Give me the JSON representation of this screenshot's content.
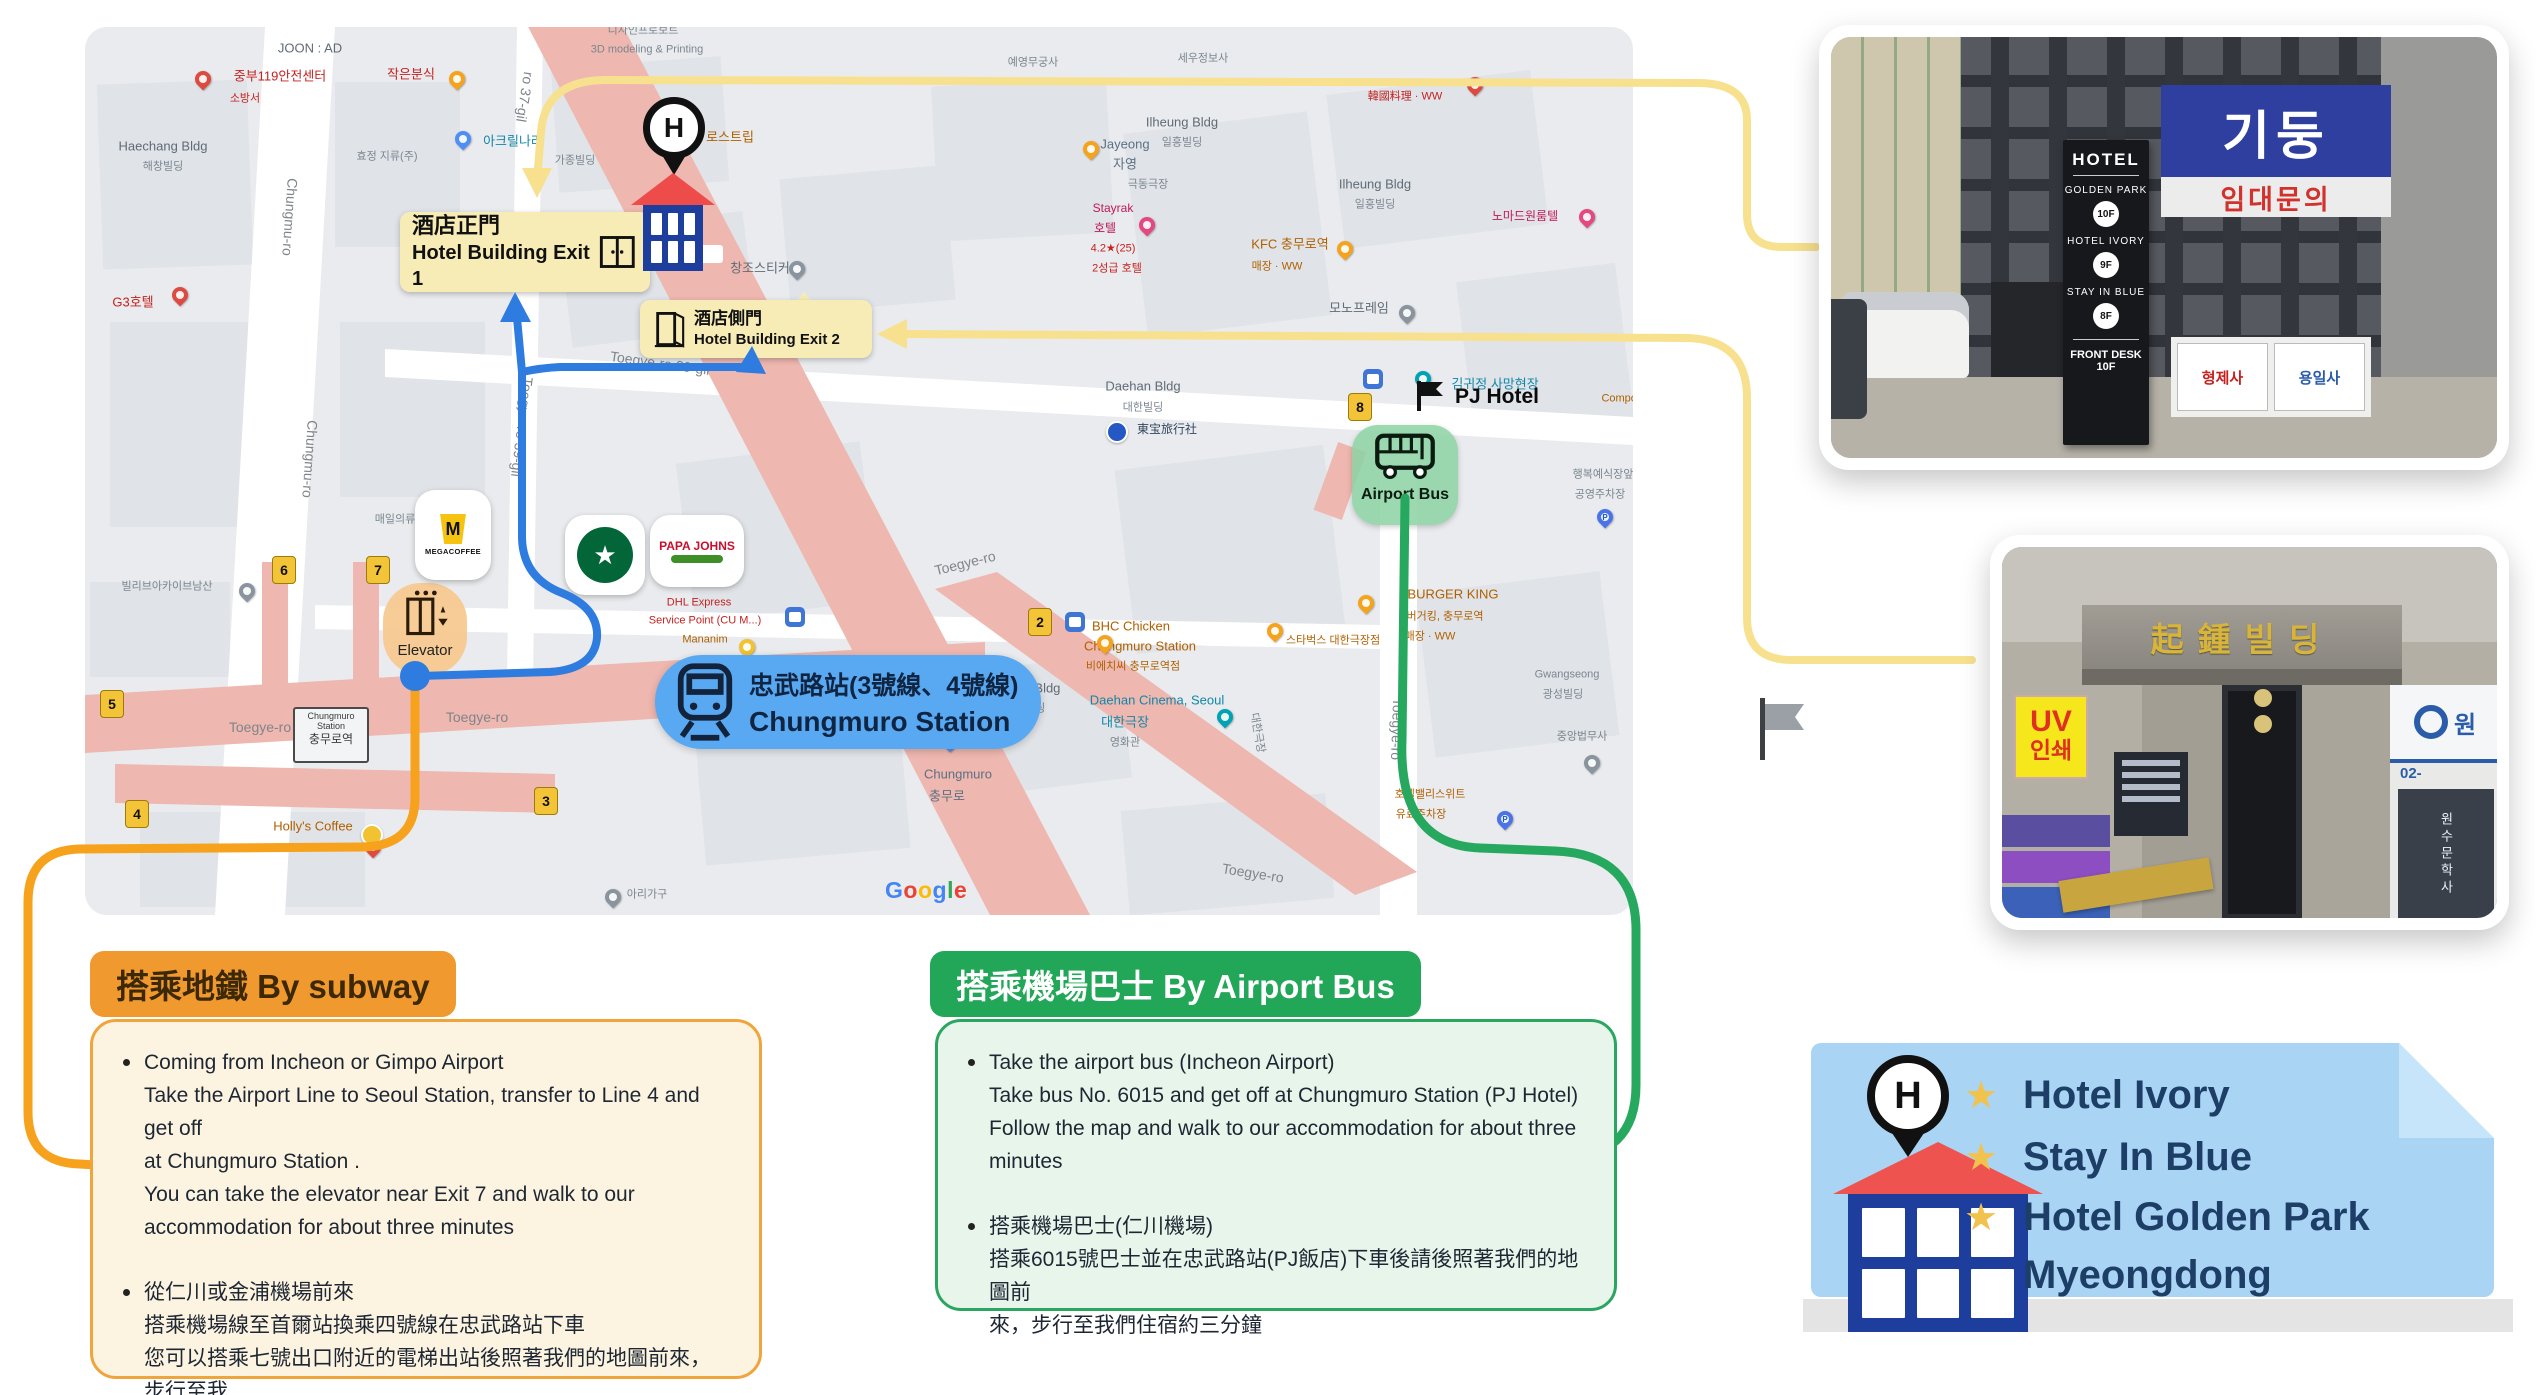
{
  "map": {
    "exit1_label": {
      "line1": "酒店正門",
      "line2": "Hotel Building Exit 1"
    },
    "exit2_label": {
      "line1": "酒店側門",
      "line2": "Hotel Building Exit 2"
    },
    "station_label": {
      "line1": "忠武路站(3號線、4號線)",
      "line2": "Chungmuro Station"
    },
    "airport_bus_label": "Airport Bus",
    "pj_hotel_label": "PJ Hotel",
    "elevator_label": "Elevator",
    "station_box": {
      "l1": "Chungmuro",
      "l2": "Station",
      "l3": "충무로역"
    },
    "google": "Google",
    "mega_m": "M",
    "mega": "MEGACOFFEE",
    "sbux": "★",
    "papa1": "PAPA JOHNS",
    "hotel_pin_letter": "H",
    "labels": [
      {
        "t": "JOON : AD",
        "x": 225,
        "y": 22,
        "cls": "gray"
      },
      {
        "t": "중부119안전센터",
        "x": 195,
        "y": 50,
        "cls": "red"
      },
      {
        "t": "소방서",
        "x": 160,
        "y": 72,
        "cls": "redsm"
      },
      {
        "t": "Haechang Bldg",
        "x": 78,
        "y": 120,
        "cls": "gray"
      },
      {
        "t": "해창빌딩",
        "x": 78,
        "y": 140,
        "cls": "graysm"
      },
      {
        "t": "G3호텔",
        "x": 48,
        "y": 276,
        "cls": "red"
      },
      {
        "t": "작은분식",
        "x": 326,
        "y": 48,
        "cls": "red"
      },
      {
        "t": "아크릴나라",
        "x": 428,
        "y": 115,
        "cls": "teal"
      },
      {
        "t": "로스트립",
        "x": 645,
        "y": 111,
        "cls": "orange"
      },
      {
        "t": "디자인프로보트",
        "x": 558,
        "y": 4,
        "cls": "graysm"
      },
      {
        "t": "3D modeling & Printing",
        "x": 562,
        "y": 23,
        "cls": "graysm"
      },
      {
        "t": "효정 지류(주)",
        "x": 302,
        "y": 130,
        "cls": "graysm"
      },
      {
        "t": "가종빌딩",
        "x": 490,
        "y": 134,
        "cls": "graysm"
      },
      {
        "t": "창조스티커",
        "x": 675,
        "y": 242,
        "cls": "gray"
      },
      {
        "t": "Jayeong",
        "x": 1040,
        "y": 118,
        "cls": "bluegray"
      },
      {
        "t": "자영",
        "x": 1040,
        "y": 138,
        "cls": "bluegray"
      },
      {
        "t": "세우정보사",
        "x": 1118,
        "y": 32,
        "cls": "graysm"
      },
      {
        "t": "예영무궁사",
        "x": 948,
        "y": 36,
        "cls": "graysm"
      },
      {
        "t": "Ilheung Bldg",
        "x": 1097,
        "y": 96,
        "cls": "gray"
      },
      {
        "t": "일흥빌딩",
        "x": 1097,
        "y": 116,
        "cls": "graysm"
      },
      {
        "t": "Ilheung Bldg",
        "x": 1290,
        "y": 158,
        "cls": "gray"
      },
      {
        "t": "일흥빌딩",
        "x": 1290,
        "y": 178,
        "cls": "graysm"
      },
      {
        "t": "극동극장",
        "x": 1063,
        "y": 158,
        "cls": "graysm"
      },
      {
        "t": "Stayrak",
        "x": 1028,
        "y": 182,
        "cls": "pink"
      },
      {
        "t": "호텔",
        "x": 1020,
        "y": 202,
        "cls": "pink"
      },
      {
        "t": "4.2★(25)",
        "x": 1028,
        "y": 222,
        "cls": "redsm"
      },
      {
        "t": "2성급 호텔",
        "x": 1032,
        "y": 242,
        "cls": "redsm"
      },
      {
        "t": "KFC 충무로역",
        "x": 1205,
        "y": 218,
        "cls": "orange"
      },
      {
        "t": "매장 · WW",
        "x": 1192,
        "y": 240,
        "cls": "orangesm"
      },
      {
        "t": "노마드원룸텔",
        "x": 1440,
        "y": 190,
        "cls": "pink"
      },
      {
        "t": "韓國料理 · WW",
        "x": 1320,
        "y": 70,
        "cls": "redsm"
      },
      {
        "t": "모노프레임",
        "x": 1274,
        "y": 282,
        "cls": "gray"
      },
      {
        "t": "Daehan Bldg",
        "x": 1058,
        "y": 360,
        "cls": "gray"
      },
      {
        "t": "대한빌딩",
        "x": 1058,
        "y": 381,
        "cls": "graysm"
      },
      {
        "t": "東宝旅行社",
        "x": 1082,
        "y": 403,
        "cls": "navy"
      },
      {
        "t": "BHC Chicken",
        "x": 1046,
        "y": 600,
        "cls": "orange"
      },
      {
        "t": "Chungmuro Station",
        "x": 1055,
        "y": 620,
        "cls": "orange"
      },
      {
        "t": "비에치씨 충무로역점",
        "x": 1048,
        "y": 640,
        "cls": "orangesm"
      },
      {
        "t": "스타벅스 대한극장점",
        "x": 1248,
        "y": 614,
        "cls": "orangesm"
      },
      {
        "t": "BURGER KING",
        "x": 1368,
        "y": 568,
        "cls": "orange"
      },
      {
        "t": "버거킹, 충무로역",
        "x": 1360,
        "y": 590,
        "cls": "orangesm"
      },
      {
        "t": "매장 · WW",
        "x": 1345,
        "y": 610,
        "cls": "orangesm"
      },
      {
        "t": "Daehan Cinema, Seoul",
        "x": 1072,
        "y": 674,
        "cls": "teal"
      },
      {
        "t": "대한극장",
        "x": 1040,
        "y": 696,
        "cls": "teal"
      },
      {
        "t": "영화관",
        "x": 1040,
        "y": 716,
        "cls": "graysm"
      },
      {
        "t": "Dongin Bldg",
        "x": 940,
        "y": 662,
        "cls": "gray"
      },
      {
        "t": "동인빌딩",
        "x": 940,
        "y": 682,
        "cls": "graysm"
      },
      {
        "t": "Russian cakes",
        "x": 815,
        "y": 708,
        "cls": "gray"
      },
      {
        "t": "Chungmuro",
        "x": 873,
        "y": 748,
        "cls": "bluegray"
      },
      {
        "t": "충무로",
        "x": 862,
        "y": 770,
        "cls": "bluegray"
      },
      {
        "t": "Gwangseong",
        "x": 1482,
        "y": 648,
        "cls": "graysm"
      },
      {
        "t": "광성빌딩",
        "x": 1478,
        "y": 668,
        "cls": "graysm"
      },
      {
        "t": "중앙법무사",
        "x": 1497,
        "y": 710,
        "cls": "graysm"
      },
      {
        "t": "행복예식장앞",
        "x": 1518,
        "y": 448,
        "cls": "graysm"
      },
      {
        "t": "공영주차장",
        "x": 1515,
        "y": 468,
        "cls": "graysm"
      },
      {
        "t": "호텔밸리스위트",
        "x": 1345,
        "y": 768,
        "cls": "orangesm"
      },
      {
        "t": "유료주차장",
        "x": 1336,
        "y": 788,
        "cls": "orangesm"
      },
      {
        "t": "김귀정 사망현장",
        "x": 1410,
        "y": 358,
        "cls": "teal"
      },
      {
        "t": "Compose",
        "x": 1540,
        "y": 372,
        "cls": "orangesm"
      },
      {
        "t": "빌리브아카이브남산",
        "x": 82,
        "y": 560,
        "cls": "graysm"
      },
      {
        "t": "매일의류",
        "x": 310,
        "y": 493,
        "cls": "graysm"
      },
      {
        "t": "DHL Express",
        "x": 614,
        "y": 576,
        "cls": "redsm"
      },
      {
        "t": "Service Point (CU M...)",
        "x": 620,
        "y": 594,
        "cls": "redsm"
      },
      {
        "t": "Mananim",
        "x": 620,
        "y": 613,
        "cls": "orangesm"
      },
      {
        "t": "Holly's Coffee",
        "x": 228,
        "y": 800,
        "cls": "orange"
      },
      {
        "t": "아리가구",
        "x": 562,
        "y": 868,
        "cls": "graysm"
      },
      {
        "t": "Chungmu-ro",
        "x": 205,
        "y": 190,
        "cls": "street",
        "rot": 94
      },
      {
        "t": "Chungmu-ro",
        "x": 225,
        "y": 432,
        "cls": "street",
        "rot": 94
      },
      {
        "t": "Toegye-ro 39-gil",
        "x": 575,
        "y": 336,
        "cls": "street",
        "rot": 8
      },
      {
        "t": "Toegye-ro 39-gil",
        "x": 437,
        "y": 400,
        "cls": "street",
        "rot": 97
      },
      {
        "t": "ro 37-gil",
        "x": 440,
        "y": 70,
        "cls": "street",
        "rot": 99
      },
      {
        "t": "Toegye-ro",
        "x": 175,
        "y": 700,
        "cls": "street"
      },
      {
        "t": "Toegye-ro",
        "x": 392,
        "y": 690,
        "cls": "street"
      },
      {
        "t": "Toegye-ro",
        "x": 880,
        "y": 536,
        "cls": "street",
        "rot": -14
      },
      {
        "t": "Toegye-ro",
        "x": 1168,
        "y": 846,
        "cls": "street",
        "rot": 9
      },
      {
        "t": "Toegye-ro",
        "x": 1312,
        "y": 702,
        "cls": "street",
        "rot": 92
      },
      {
        "t": "대한극장",
        "x": 1172,
        "y": 706,
        "cls": "graysm",
        "rot": 80
      }
    ],
    "pins": [
      {
        "x": 118,
        "y": 62,
        "c": "red"
      },
      {
        "x": 372,
        "y": 62,
        "c": "orange"
      },
      {
        "x": 378,
        "y": 122,
        "c": "blue"
      },
      {
        "x": 95,
        "y": 278,
        "c": "red"
      },
      {
        "x": 712,
        "y": 252,
        "c": "gray"
      },
      {
        "x": 1006,
        "y": 132,
        "c": "orange"
      },
      {
        "x": 1062,
        "y": 208,
        "c": "pink"
      },
      {
        "x": 1260,
        "y": 232,
        "c": "orange"
      },
      {
        "x": 1502,
        "y": 200,
        "c": "pink"
      },
      {
        "x": 1390,
        "y": 68,
        "c": "red"
      },
      {
        "x": 1322,
        "y": 296,
        "c": "gray"
      },
      {
        "x": 1020,
        "y": 626,
        "c": "orange"
      },
      {
        "x": 1140,
        "y": 700,
        "c": "cyan"
      },
      {
        "x": 1190,
        "y": 614,
        "c": "orange"
      },
      {
        "x": 1281,
        "y": 586,
        "c": "orange"
      },
      {
        "x": 865,
        "y": 724,
        "c": "blue"
      },
      {
        "x": 1520,
        "y": 500,
        "c": "pblue",
        "g": "P"
      },
      {
        "x": 1507,
        "y": 746,
        "c": "gray"
      },
      {
        "x": 1338,
        "y": 362,
        "c": "cyan"
      },
      {
        "x": 162,
        "y": 574,
        "c": "gray"
      },
      {
        "x": 528,
        "y": 880,
        "c": "gray"
      },
      {
        "x": 662,
        "y": 630,
        "c": "yellow"
      },
      {
        "x": 288,
        "y": 830,
        "c": "red"
      },
      {
        "x": 1420,
        "y": 802,
        "c": "pblue",
        "g": "P"
      },
      {
        "x": 285,
        "y": 806,
        "c": "yellow",
        "t": "circle"
      },
      {
        "x": 1030,
        "y": 403,
        "c": "dot",
        "t": "circle"
      }
    ],
    "exits": [
      {
        "n": "2",
        "x": 943,
        "y": 581
      },
      {
        "n": "3",
        "x": 449,
        "y": 760
      },
      {
        "n": "4",
        "x": 40,
        "y": 773
      },
      {
        "n": "5",
        "x": 15,
        "y": 663
      },
      {
        "n": "6",
        "x": 187,
        "y": 529
      },
      {
        "n": "7",
        "x": 281,
        "y": 529
      },
      {
        "n": "8",
        "x": 1263,
        "y": 366
      }
    ],
    "busstops": [
      {
        "x": 700,
        "y": 580
      },
      {
        "x": 980,
        "y": 585
      },
      {
        "x": 1278,
        "y": 342
      }
    ]
  },
  "subway_section": {
    "badge": "搭乘地鐵 By subway",
    "bullets": [
      {
        "lines": [
          "Coming from Incheon or Gimpo Airport",
          "Take the Airport Line to Seoul Station, transfer to Line 4 and get off",
          "at Chungmuro Station .",
          "You can take the elevator near Exit 7 and walk to our",
          "accommodation for about three minutes"
        ]
      },
      {
        "lines": [
          "從仁川或金浦機場前來",
          "搭乘機場線至首爾站換乘四號線在忠武路站下車",
          "您可以搭乘七號出口附近的電梯出站後照著我們的地圖前來，步行至我",
          "們住宿約三分鐘"
        ]
      }
    ]
  },
  "bus_section": {
    "badge": "搭乘機場巴士 By Airport Bus",
    "bullets": [
      {
        "lines": [
          "Take the airport bus (Incheon Airport)",
          "Take bus No. 6015 and get off at Chungmuro Station (PJ Hotel)",
          "Follow the map and walk to our accommodation for about three",
          "minutes"
        ]
      },
      {
        "lines": [
          "搭乘機場巴士(仁川機場)",
          "搭乘6015號巴士並在忠武路站(PJ飯店)下車後請後照著我們的地圖前",
          "來，步行至我們住宿約三分鐘"
        ]
      }
    ]
  },
  "photo1": {
    "sign": {
      "title": "HOTEL",
      "rows": [
        {
          "name": "GOLDEN PARK",
          "floor": "10F"
        },
        {
          "name": "HOTEL IVORY",
          "floor": "9F"
        },
        {
          "name": "STAY IN BLUE",
          "floor": "8F"
        }
      ],
      "footer": "FRONT DESK 10F"
    },
    "korean_sign": "기둥",
    "lease_sign": "임대문의",
    "side_sign1": "형제사",
    "side_sign2": "용일사"
  },
  "photo2": {
    "building_sign": "起鍾빌딩",
    "uv_line1": "UV",
    "uv_line2": "인쇄",
    "phone": "02-",
    "logo_text": "원",
    "window_text": "원수문학사"
  },
  "hotel_card": {
    "items": [
      "Hotel Ivory",
      "Stay In Blue",
      "Hotel Golden Park"
    ],
    "continuation": "Myeongdong",
    "star": "★",
    "pin_letter": "H",
    "accent_blue": "#a9d4f4",
    "text_navy": "#1d3e66",
    "star_gold": "#f1c24c"
  },
  "colors": {
    "route_yellow": "#f7e18e",
    "route_orange": "#f6a21c",
    "route_green": "#27a85f",
    "route_blue": "#2e7ce0",
    "road_pink": "#eeb7af",
    "badge_orange": "#f0992e",
    "badge_green": "#21a757"
  }
}
